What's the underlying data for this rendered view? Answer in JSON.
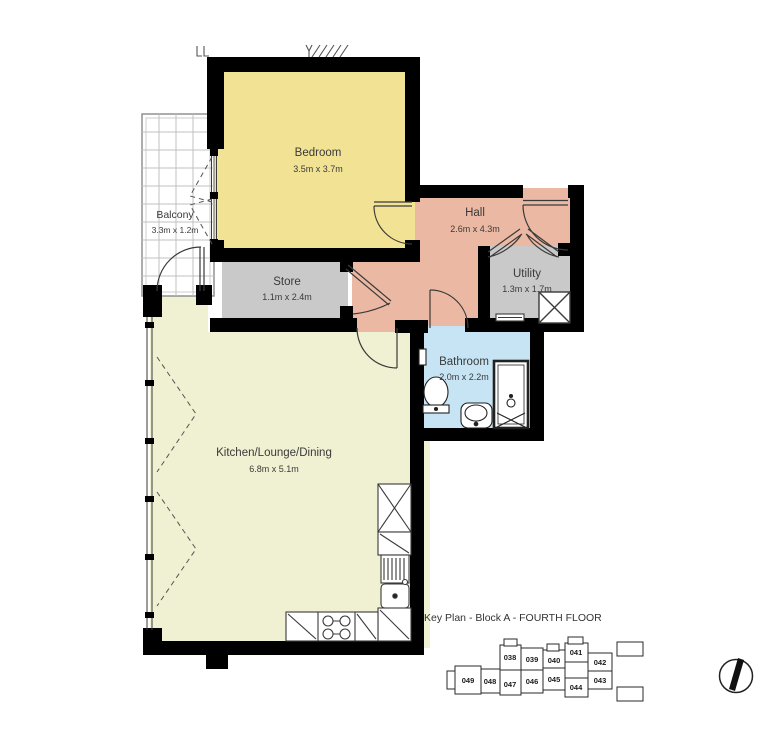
{
  "rooms": {
    "bedroom": {
      "name": "Bedroom",
      "dims": "3.5m x 3.7m",
      "color": "#F2E394"
    },
    "balcony": {
      "name": "Balcony",
      "dims": "3.3m x 1.2m",
      "color": "#FFFFFF"
    },
    "hall": {
      "name": "Hall",
      "dims": "2.6m x 4.3m",
      "color": "#EBB9A3"
    },
    "store": {
      "name": "Store",
      "dims": "1.1m x 2.4m",
      "color": "#C9C9C9"
    },
    "utility": {
      "name": "Utility",
      "dims": "1.3m x 1.7m",
      "color": "#C9C9C9"
    },
    "bathroom": {
      "name": "Bathroom",
      "dims": "2.0m x 2.2m",
      "color": "#C7E4F4"
    },
    "kitchen": {
      "name": "Kitchen/Lounge/Dining",
      "dims": "6.8m x 5.1m",
      "color": "#F0F0D2"
    }
  },
  "key_plan": {
    "title": "Key Plan - Block A - FOURTH FLOOR",
    "units": [
      "038",
      "039",
      "040",
      "041",
      "042",
      "043",
      "044",
      "045",
      "046",
      "047",
      "048",
      "049"
    ]
  },
  "colors": {
    "wall": "#000000",
    "line": "#3a3a3a",
    "light_line": "#555555",
    "grid": "#c0c0c0",
    "text": "#3a3a3a"
  }
}
